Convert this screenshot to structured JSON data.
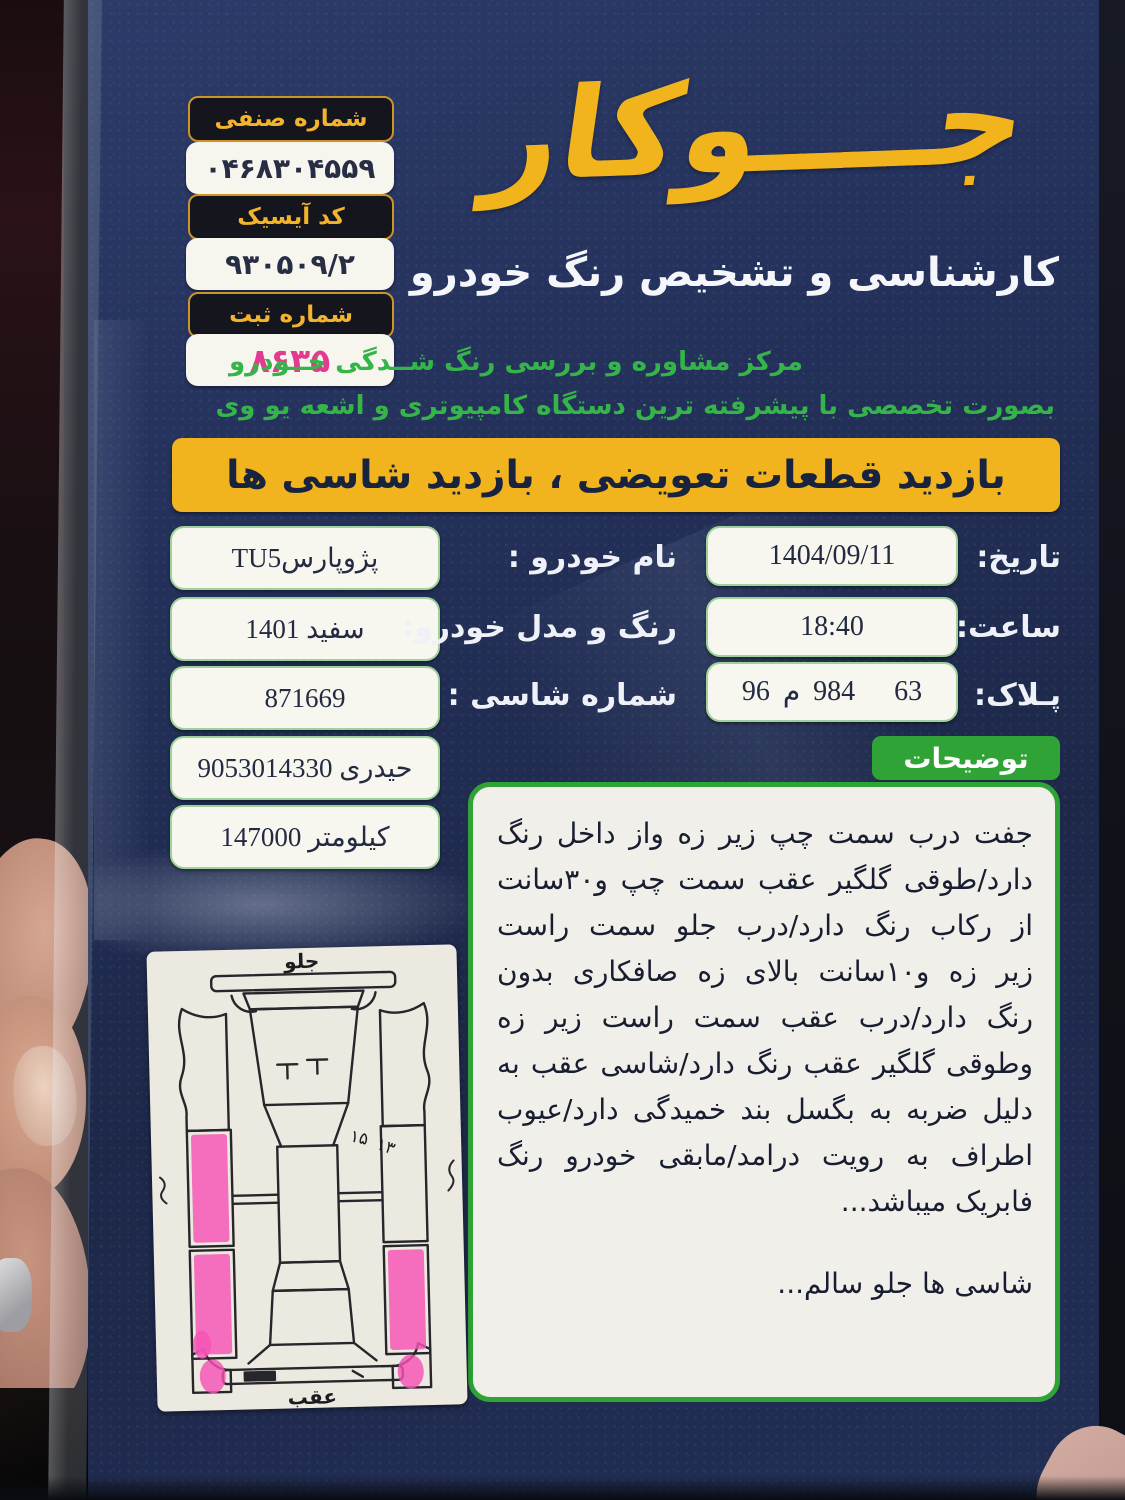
{
  "registration_badges": [
    {
      "label": "شماره صنفی",
      "value": "۰۴۶۸۳۰۴۵۵۹"
    },
    {
      "label": "کد آیسیک",
      "value": "۹۳۰۵۰۹/۲"
    },
    {
      "label": "شماره ثبت",
      "value": "۸۶۳۵"
    }
  ],
  "brand": {
    "logo": "جــــوکار",
    "tagline": "کارشناسی و تشخیص رنگ خودرو",
    "subtitle1": "مرکز مشاوره و بررسی رنگ شــدگی خــودرو",
    "subtitle2": "بصورت تخصصی با پیشرفته ترین دستگاه کامپیوتری و اشعه یو وی"
  },
  "banner": {
    "text": "بازدید قطعات تعویضی ، بازدید شاسی ها"
  },
  "vehicle": {
    "name_label": "نام خودرو :",
    "name_value": "پژوپارسTU5",
    "color_model_label": "رنگ و مدل خودرو:",
    "color_model_value": "سفید  1401",
    "chassis_label": "شماره شاسی :",
    "chassis_value": "871669",
    "owner_value": "حیدری  9053014330",
    "km_value": "کیلومتر  147000"
  },
  "visit": {
    "date_label": "تاریخ:",
    "date_value": "1404/09/11",
    "time_label": "ساعت:",
    "time_value": "18:40",
    "plate_label": "پـلاک:",
    "plate_parts": [
      "96",
      "م",
      "984",
      "63"
    ]
  },
  "notes": {
    "badge": "توضیحات",
    "lines": [
      "جفت درب سمت چپ زیر زه  واز داخل رنگ",
      "دارد/طوقی گلگیر عقب سمت چپ و۳۰سانت",
      "از رکاب رنگ دارد/درب جلو سمت راست",
      "زیر زه و۱۰سانت بالای زه صافکاری بدون",
      "رنگ دارد/درب عقب سمت راست زیر زه",
      "وطوقی گلگیر عقب رنگ دارد/شاسی عقب به",
      "دلیل ضربه به بگسل بند خمیدگی دارد/عیوب",
      "اطراف به رویت درامد/مابقی خودرو رنگ",
      "فابریک میباشد..."
    ],
    "footer": "شاسی ها جلو سالم..."
  },
  "diagram": {
    "front_label": "جلو",
    "rear_label": "عقب",
    "marks": [
      "۱۵",
      "۱۳"
    ]
  },
  "colors": {
    "card_navy": "#22305a",
    "accent_yellow": "#f1b41e",
    "accent_green": "#2fa336",
    "text_green": "#35b44a",
    "highlight_pink": "#f553b5",
    "stamp_pink": "#e23a8e"
  }
}
